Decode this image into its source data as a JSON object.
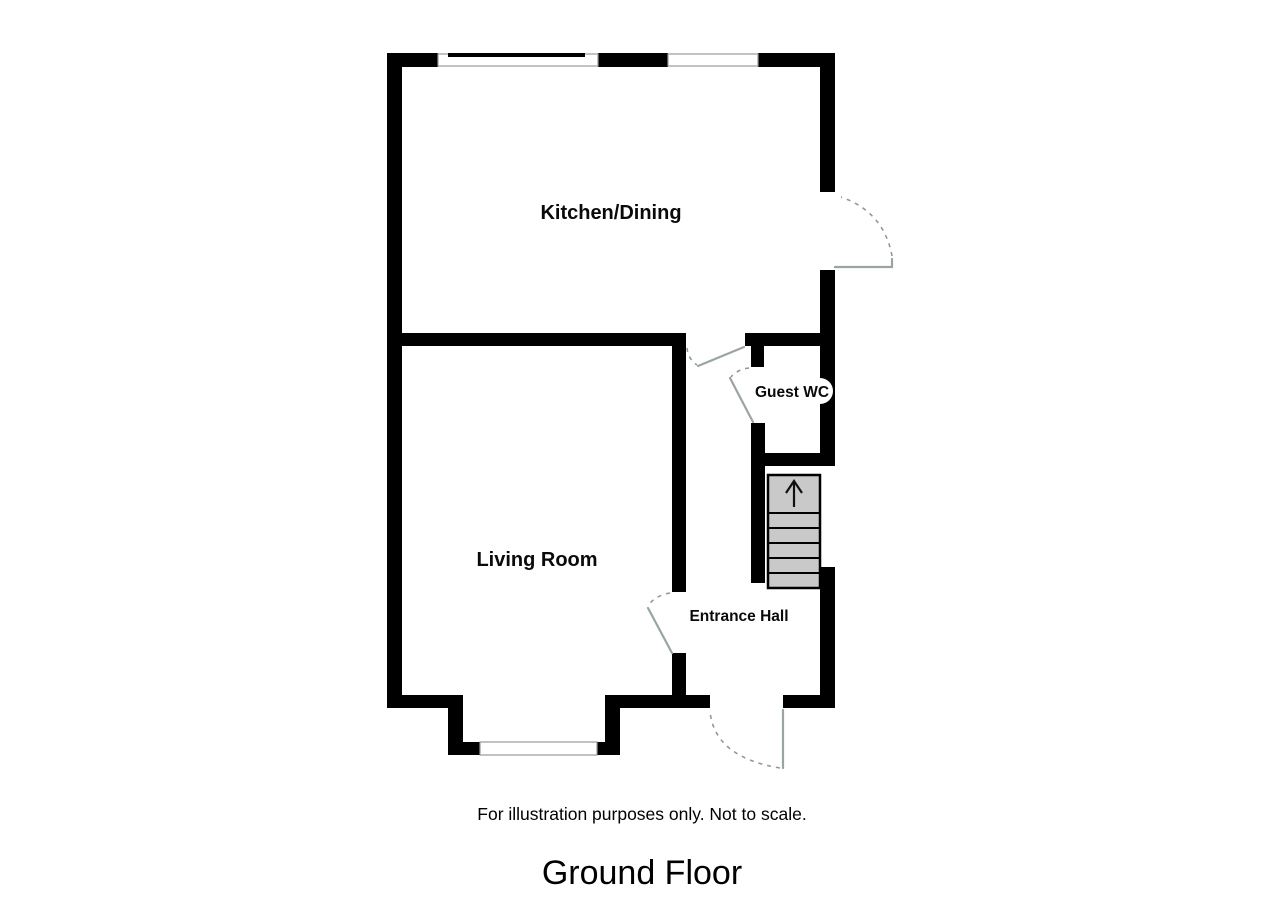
{
  "floorplan": {
    "rooms": {
      "kitchen": "Kitchen/Dining",
      "living": "Living Room",
      "wc": "Guest WC",
      "hall": "Entrance Hall"
    },
    "stairs": {
      "arrow_icon": "up-arrow"
    },
    "disclaimer": "For illustration purposes only. Not to scale.",
    "floor_title": "Ground Floor",
    "colors": {
      "wall": "#000000",
      "stair_fill": "#c9c9c9",
      "door_line": "#9aa4a4",
      "door_arc": "#8f9999",
      "window_outline": "#9a9a9a",
      "background": "#ffffff",
      "text": "#0a0a0a"
    }
  }
}
